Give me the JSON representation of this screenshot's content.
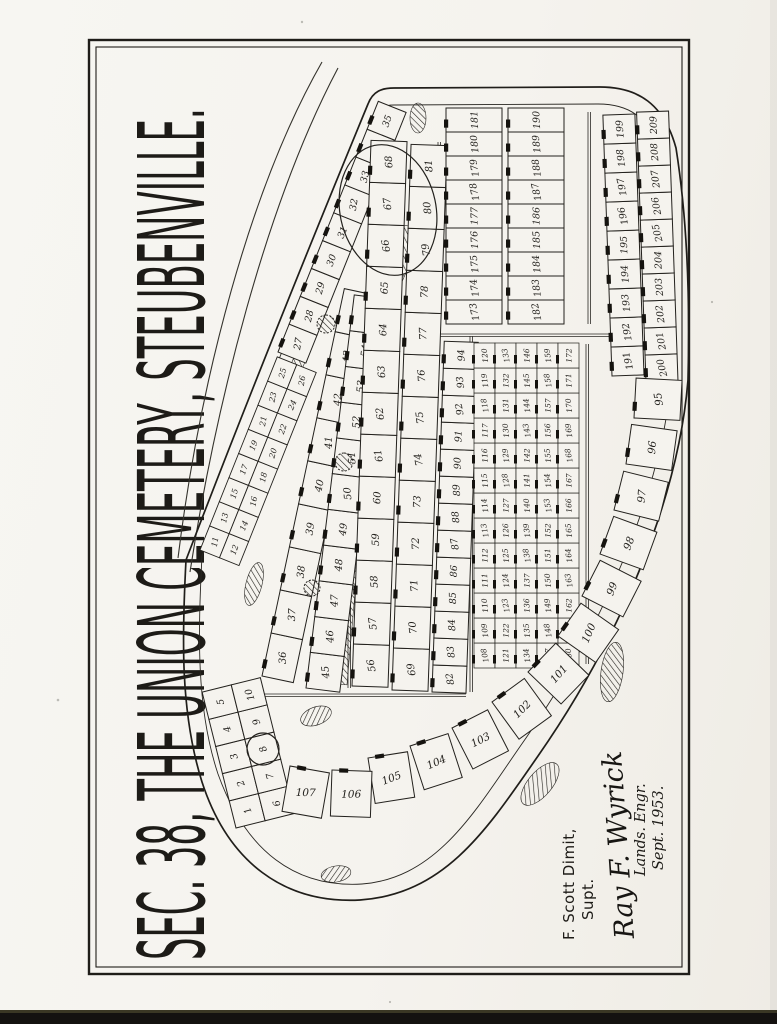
{
  "document": {
    "kind": "scanned hand-drawn cemetery plat",
    "orientation": "drawing rotated 90 degrees counter-clockwise on portrait sheet"
  },
  "title": {
    "text": "SEC. 38, THE UNION CEMETERY, STEUBENVILLE."
  },
  "signature": {
    "superintendent": "F. Scott Dimit,",
    "superintendent_title": "Supt.",
    "engineer": "Ray F. Wyrick",
    "engineer_title": "Lands. Engr.",
    "date": "Sept. 1953."
  },
  "map": {
    "section_label": "38",
    "lot_range": "1-209",
    "circled_lots": [
      "8",
      "132"
    ],
    "ink_color": "#201e1a",
    "paper_color": "#f5f3ee",
    "blocks": {
      "tip": [
        [
          1,
          2,
          3,
          4,
          5
        ],
        [
          6,
          7,
          8,
          9,
          10
        ]
      ],
      "edge_pairs": [
        [
          11,
          13,
          15,
          17,
          19,
          21,
          23,
          25
        ],
        [
          12,
          14,
          16,
          18,
          20,
          22,
          24,
          26
        ]
      ],
      "edge_singles": [
        [
          27,
          28,
          29,
          30,
          31,
          32,
          33,
          34,
          35
        ]
      ],
      "fan_a": [
        [
          36,
          37,
          38,
          39,
          40,
          41,
          42,
          43,
          44
        ]
      ],
      "fan_b": [
        [
          45,
          46,
          47,
          48,
          49,
          50,
          51,
          52,
          53,
          54,
          55
        ]
      ],
      "mid_1": [
        [
          56,
          57,
          58,
          59,
          60,
          61,
          62,
          63,
          64,
          65,
          66,
          67,
          68
        ]
      ],
      "mid_2": [
        [
          69,
          70,
          71,
          72,
          73,
          74,
          75,
          76,
          77,
          78,
          79,
          80,
          81
        ]
      ],
      "mid_3": [
        [
          82,
          83,
          84,
          85,
          86,
          87,
          88,
          89,
          90,
          91,
          92,
          93,
          94
        ]
      ],
      "corner_arc": [
        95,
        96,
        97,
        98,
        99,
        100,
        101,
        102,
        103,
        104,
        105,
        106,
        107
      ],
      "grid": [
        [
          108,
          109,
          110,
          111,
          112,
          113,
          114,
          115,
          116,
          117,
          118,
          119,
          120
        ],
        [
          121,
          122,
          123,
          124,
          125,
          126,
          127,
          128,
          129,
          130,
          131,
          132,
          133
        ],
        [
          134,
          135,
          136,
          137,
          138,
          139,
          140,
          141,
          142,
          143,
          144,
          145,
          146
        ],
        [
          147,
          148,
          149,
          150,
          151,
          152,
          153,
          154,
          155,
          156,
          157,
          158,
          159
        ],
        [
          160,
          161,
          162,
          163,
          164,
          165,
          166,
          167,
          168,
          169,
          170,
          171,
          172
        ]
      ],
      "east_1": [
        [
          173,
          174,
          175,
          176,
          177,
          178,
          179,
          180,
          181
        ]
      ],
      "east_2": [
        [
          182,
          183,
          184,
          185,
          186,
          187,
          188,
          189,
          190
        ]
      ],
      "south_1": [
        [
          191,
          192,
          193,
          194,
          195,
          196,
          197,
          198,
          199
        ]
      ],
      "south_2": [
        [
          200,
          201,
          202,
          203,
          204,
          205,
          206,
          207,
          208,
          209
        ]
      ]
    }
  }
}
